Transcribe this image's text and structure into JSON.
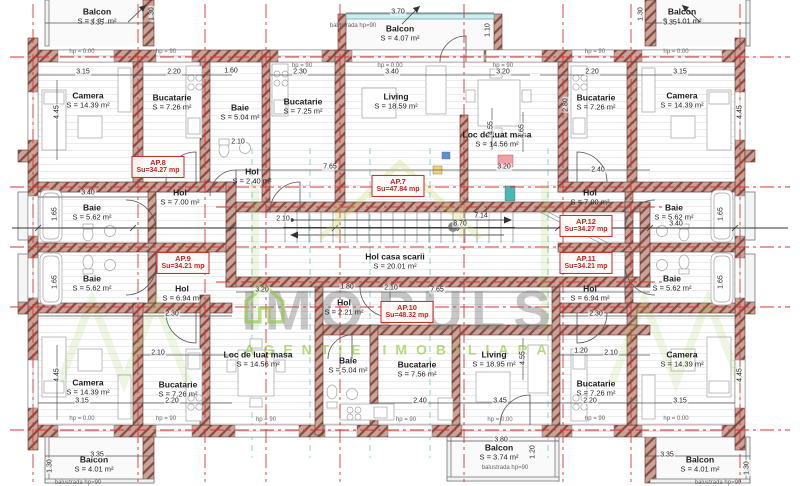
{
  "palette": {
    "accent_red": "#cc2222",
    "wall_brown": "#9c5a4b",
    "watermark_green": "#8dc63f",
    "axis_red": "#e03131"
  },
  "watermark": {
    "brand_left": "IMO",
    "brand_right": "PULS",
    "subtitle": "AGENTIE IMOBILIARA"
  },
  "apartments": [
    {
      "id": "AP.7",
      "su": "Su=47.84 mp",
      "x": 398,
      "y": 186
    },
    {
      "id": "AP.8",
      "su": "Su=34.27 mp",
      "x": 158,
      "y": 167
    },
    {
      "id": "AP.9",
      "su": "Su=34.21 mp",
      "x": 183,
      "y": 263
    },
    {
      "id": "AP.10",
      "su": "Su=48.32 mp",
      "x": 407,
      "y": 312
    },
    {
      "id": "AP.11",
      "su": "Su=34.21 mp",
      "x": 586,
      "y": 263
    },
    {
      "id": "AP.12",
      "su": "Su=34.27 mp",
      "x": 586,
      "y": 226
    }
  ],
  "rooms": [
    {
      "name": "Balcon",
      "area": "S = 4.01 m²",
      "x": 97,
      "y": 16
    },
    {
      "name": "Balcon",
      "area": "S = 4.07 m²",
      "x": 400,
      "y": 33
    },
    {
      "name": "Balcon",
      "area": "S = 4.01 m²",
      "x": 682,
      "y": 16
    },
    {
      "name": "Camera",
      "area": "S = 14.39 m²",
      "x": 88,
      "y": 100
    },
    {
      "name": "Bucatarie",
      "area": "S = 7.26 m²",
      "x": 172,
      "y": 102
    },
    {
      "name": "Baie",
      "area": "S = 5.04 m²",
      "x": 240,
      "y": 112
    },
    {
      "name": "Bucatarie",
      "area": "S = 7.25 m²",
      "x": 303,
      "y": 106
    },
    {
      "name": "Living",
      "area": "S = 18.59 m²",
      "x": 396,
      "y": 101
    },
    {
      "name": "Loc de luat masa",
      "area": "S = 14.56 m²",
      "x": 497,
      "y": 139
    },
    {
      "name": "Bucatarie",
      "area": "S = 7.26 m²",
      "x": 596,
      "y": 102
    },
    {
      "name": "Camera",
      "area": "S = 14.39 m²",
      "x": 682,
      "y": 100
    },
    {
      "name": "Hol",
      "area": "S = 2.40 m²",
      "x": 252,
      "y": 176
    },
    {
      "name": "Hol",
      "area": "S = 7.00 m²",
      "x": 180,
      "y": 197
    },
    {
      "name": "Baie",
      "area": "S = 5.62 m²",
      "x": 92,
      "y": 212
    },
    {
      "name": "Baie",
      "area": "S = 5.62 m²",
      "x": 92,
      "y": 283
    },
    {
      "name": "Hol",
      "area": "S = 6.94 m²",
      "x": 182,
      "y": 293
    },
    {
      "name": "Hol",
      "area": "S = 7.00 m²",
      "x": 590,
      "y": 197
    },
    {
      "name": "Baie",
      "area": "S = 5.62 m²",
      "x": 674,
      "y": 212
    },
    {
      "name": "Baie",
      "area": "S = 5.62 m²",
      "x": 672,
      "y": 283
    },
    {
      "name": "Hol",
      "area": "S = 6.94 m²",
      "x": 590,
      "y": 293
    },
    {
      "name": "Hol casa scarii",
      "area": "S = 20.01 m²",
      "x": 395,
      "y": 261
    },
    {
      "name": "Hol",
      "area": "S = 2.21 m²",
      "x": 344,
      "y": 307
    },
    {
      "name": "Loc de luat masa",
      "area": "S = 14.56 m²",
      "x": 258,
      "y": 359
    },
    {
      "name": "Baie",
      "area": "S = 5.04 m²",
      "x": 348,
      "y": 365
    },
    {
      "name": "Bucatarie",
      "area": "S = 7.56 m²",
      "x": 417,
      "y": 369
    },
    {
      "name": "Living",
      "area": "S = 18.95 m²",
      "x": 494,
      "y": 359
    },
    {
      "name": "Camera",
      "area": "S = 14.39 m²",
      "x": 88,
      "y": 387
    },
    {
      "name": "Bucatarie",
      "area": "S = 7.26 m²",
      "x": 178,
      "y": 389
    },
    {
      "name": "Bucatarie",
      "area": "S = 7.26 m²",
      "x": 596,
      "y": 388
    },
    {
      "name": "Camera",
      "area": "S = 14.39 m²",
      "x": 682,
      "y": 359
    },
    {
      "name": "Balcon",
      "area": "S = 4.01 m²",
      "x": 94,
      "y": 464
    },
    {
      "name": "Balcon",
      "area": "S = 3.74 m²",
      "x": 499,
      "y": 452
    },
    {
      "name": "Balcon",
      "area": "S = 4.01 m²",
      "x": 700,
      "y": 464
    }
  ],
  "dims": [
    {
      "t": "3.35",
      "x": 97,
      "y": 23
    },
    {
      "t": "3.70",
      "x": 398,
      "y": 12
    },
    {
      "t": "3.35",
      "x": 670,
      "y": 23
    },
    {
      "t": "1.30",
      "x": 152,
      "y": 14,
      "v": 1
    },
    {
      "t": "1.30",
      "x": 641,
      "y": 14,
      "v": 1
    },
    {
      "t": "1.10",
      "x": 488,
      "y": 30,
      "v": 1
    },
    {
      "t": "3.15",
      "x": 83,
      "y": 72
    },
    {
      "t": "2.20",
      "x": 174,
      "y": 72
    },
    {
      "t": "1.60",
      "x": 231,
      "y": 71
    },
    {
      "t": "2.30",
      "x": 300,
      "y": 72
    },
    {
      "t": "3.40",
      "x": 392,
      "y": 72
    },
    {
      "t": "3.20",
      "x": 503,
      "y": 72
    },
    {
      "t": "2.20",
      "x": 592,
      "y": 72
    },
    {
      "t": "3.15",
      "x": 680,
      "y": 72
    },
    {
      "t": "4.45",
      "x": 57,
      "y": 112,
      "v": 1
    },
    {
      "t": "4.45",
      "x": 740,
      "y": 112,
      "v": 1
    },
    {
      "t": "4.55",
      "x": 491,
      "y": 128,
      "v": 1
    },
    {
      "t": "4.65",
      "x": 522,
      "y": 131,
      "v": 1
    },
    {
      "t": "2.80",
      "x": 566,
      "y": 105,
      "v": 1
    },
    {
      "t": "2.10",
      "x": 238,
      "y": 142
    },
    {
      "t": "3.40",
      "x": 88,
      "y": 193
    },
    {
      "t": "2.40",
      "x": 598,
      "y": 170
    },
    {
      "t": "7.65",
      "x": 330,
      "y": 167
    },
    {
      "t": "3.20",
      "x": 504,
      "y": 167
    },
    {
      "t": "2.10",
      "x": 283,
      "y": 219
    },
    {
      "t": "3.40",
      "x": 676,
      "y": 224
    },
    {
      "t": "8.70",
      "x": 460,
      "y": 224
    },
    {
      "t": "7.14",
      "x": 481,
      "y": 216
    },
    {
      "t": "1.65",
      "x": 55,
      "y": 214,
      "v": 1
    },
    {
      "t": "1.65",
      "x": 55,
      "y": 282,
      "v": 1
    },
    {
      "t": "1.65",
      "x": 721,
      "y": 214,
      "v": 1
    },
    {
      "t": "1.65",
      "x": 721,
      "y": 282,
      "v": 1
    },
    {
      "t": "3.20",
      "x": 262,
      "y": 290
    },
    {
      "t": "1.80",
      "x": 347,
      "y": 287
    },
    {
      "t": "2.10",
      "x": 391,
      "y": 288
    },
    {
      "t": "7.65",
      "x": 437,
      "y": 290
    },
    {
      "t": "2.30",
      "x": 172,
      "y": 314
    },
    {
      "t": "2.30",
      "x": 596,
      "y": 314
    },
    {
      "t": "2.10",
      "x": 158,
      "y": 353
    },
    {
      "t": "1.20",
      "x": 581,
      "y": 351
    },
    {
      "t": "2.10",
      "x": 611,
      "y": 353
    },
    {
      "t": "3.15",
      "x": 82,
      "y": 401
    },
    {
      "t": "2.20",
      "x": 172,
      "y": 401
    },
    {
      "t": "2.40",
      "x": 420,
      "y": 401
    },
    {
      "t": "3.45",
      "x": 500,
      "y": 401
    },
    {
      "t": "2.20",
      "x": 590,
      "y": 401
    },
    {
      "t": "3.15",
      "x": 680,
      "y": 401
    },
    {
      "t": "4.45",
      "x": 57,
      "y": 375,
      "v": 1
    },
    {
      "t": "4.45",
      "x": 740,
      "y": 375,
      "v": 1
    },
    {
      "t": "4.55",
      "x": 523,
      "y": 358,
      "v": 1
    },
    {
      "t": "3.35",
      "x": 97,
      "y": 455
    },
    {
      "t": "3.80",
      "x": 501,
      "y": 440
    },
    {
      "t": "3.35",
      "x": 667,
      "y": 455
    },
    {
      "t": "1.30",
      "x": 50,
      "y": 466,
      "v": 1
    },
    {
      "t": "1.30",
      "x": 747,
      "y": 468,
      "v": 1
    },
    {
      "t": "1.20",
      "x": 533,
      "y": 452,
      "v": 1
    }
  ],
  "annotations": [
    {
      "t": "hp = 0.00",
      "x": 82,
      "y": 52
    },
    {
      "t": "hp = 90",
      "x": 166,
      "y": 52
    },
    {
      "t": "hp = 90",
      "x": 302,
      "y": 66
    },
    {
      "t": "hp = 0.00",
      "x": 390,
      "y": 66
    },
    {
      "t": "hp = 90",
      "x": 503,
      "y": 66
    },
    {
      "t": "hp = 90",
      "x": 595,
      "y": 52
    },
    {
      "t": "hp = 0.00",
      "x": 676,
      "y": 52
    },
    {
      "t": "hp = 0.00",
      "x": 82,
      "y": 419
    },
    {
      "t": "hp = 90",
      "x": 166,
      "y": 419
    },
    {
      "t": "hp = 90",
      "x": 266,
      "y": 420
    },
    {
      "t": "hp = 90",
      "x": 406,
      "y": 420
    },
    {
      "t": "hp = 0.00",
      "x": 500,
      "y": 420
    },
    {
      "t": "hp = 90",
      "x": 595,
      "y": 419
    },
    {
      "t": "hp = 0.00",
      "x": 676,
      "y": 419
    },
    {
      "t": "balustrada hp=90",
      "x": 353,
      "y": 26
    },
    {
      "t": "balustrada hp=90",
      "x": 505,
      "y": 468
    },
    {
      "t": "balustrada hp=90",
      "x": 78,
      "y": 483
    },
    {
      "t": "balustrada hp=90",
      "x": 718,
      "y": 483
    }
  ]
}
